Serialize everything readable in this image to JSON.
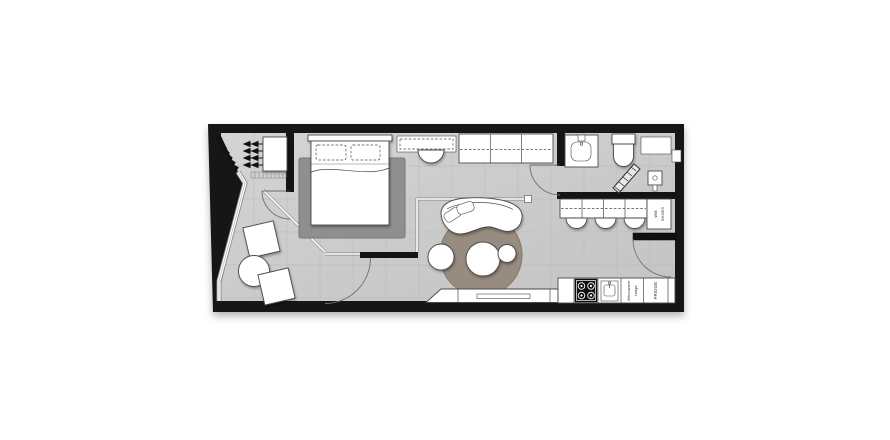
{
  "labels": {
    "fridge": "FRIDGE",
    "microwave_lines": [
      "Microwave",
      "range"
    ],
    "wm_lines": [
      "WM",
      "SHOES"
    ]
  },
  "colors": {
    "wall": "#141414",
    "floor": "#cdcdcd",
    "tile_line": "#bcbcbc",
    "outline": "#4a4a4a",
    "glass": "#8a8a8a",
    "rug_bedroom": "#8f8f8f",
    "rug_living": "#978c7f",
    "label_ink": "#2b2b2b",
    "background": "#ffffff"
  }
}
